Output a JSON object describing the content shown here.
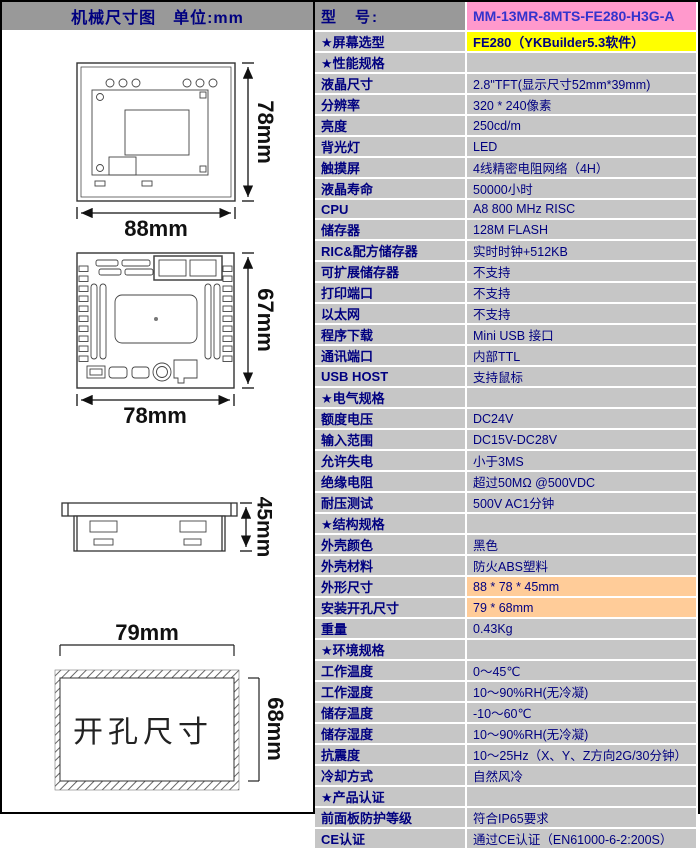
{
  "left_panel": {
    "header": "机械尺寸图　单位:mm",
    "front_view": {
      "width": "88mm",
      "height": "78mm"
    },
    "back_view": {
      "width": "78mm",
      "height": "67mm"
    },
    "side_view": {
      "depth": "45mm"
    },
    "cutout": {
      "width": "79mm",
      "height": "68mm",
      "label": "开孔尺寸"
    }
  },
  "spec_table": {
    "rows": [
      {
        "type": "model",
        "label": "型　号:",
        "value": "MM-13MR-8MTS-FE280-H3G-A"
      },
      {
        "type": "yellow",
        "label": "★屏幕选型",
        "value": "FE280（YKBuilder5.3软件）"
      },
      {
        "type": "section",
        "label": "★性能规格",
        "value": ""
      },
      {
        "type": "normal",
        "label": "液晶尺寸",
        "value": "2.8\"TFT(显示尺寸52mm*39mm)"
      },
      {
        "type": "normal",
        "label": "分辨率",
        "value": "320 * 240像素"
      },
      {
        "type": "normal",
        "label": "亮度",
        "value": "250cd/m"
      },
      {
        "type": "normal",
        "label": "背光灯",
        "value": "LED"
      },
      {
        "type": "normal",
        "label": "触摸屏",
        "value": "4线精密电阻网络（4H）"
      },
      {
        "type": "normal",
        "label": "液晶寿命",
        "value": "50000小时"
      },
      {
        "type": "normal",
        "label": "CPU",
        "value": "A8 800 MHz RISC"
      },
      {
        "type": "normal",
        "label": "储存器",
        "value": "128M FLASH"
      },
      {
        "type": "normal",
        "label": "RIC&配方储存器",
        "value": "实时时钟+512KB"
      },
      {
        "type": "normal",
        "label": "可扩展储存器",
        "value": "不支持"
      },
      {
        "type": "normal",
        "label": "打印端口",
        "value": "不支持"
      },
      {
        "type": "normal",
        "label": "以太网",
        "value": "不支持"
      },
      {
        "type": "normal",
        "label": "程序下载",
        "value": "Mini USB 接口"
      },
      {
        "type": "normal",
        "label": "通讯端口",
        "value": "内部TTL"
      },
      {
        "type": "normal",
        "label": "USB HOST",
        "value": "支持鼠标"
      },
      {
        "type": "section",
        "label": "★电气规格",
        "value": ""
      },
      {
        "type": "normal",
        "label": "额度电压",
        "value": "DC24V"
      },
      {
        "type": "normal",
        "label": "输入范围",
        "value": "DC15V-DC28V"
      },
      {
        "type": "normal",
        "label": "允许失电",
        "value": "小于3MS"
      },
      {
        "type": "normal",
        "label": "绝缘电阻",
        "value": "超过50MΩ @500VDC"
      },
      {
        "type": "normal",
        "label": "耐压测试",
        "value": "500V AC1分钟"
      },
      {
        "type": "section",
        "label": "★结构规格",
        "value": ""
      },
      {
        "type": "normal",
        "label": "外壳颜色",
        "value": "黑色"
      },
      {
        "type": "normal",
        "label": "外壳材料",
        "value": "防火ABS塑料"
      },
      {
        "type": "orange",
        "label": "外形尺寸",
        "value": "88 * 78 * 45mm"
      },
      {
        "type": "orange",
        "label": "安装开孔尺寸",
        "value": "79 * 68mm"
      },
      {
        "type": "normal",
        "label": "重量",
        "value": "0.43Kg"
      },
      {
        "type": "section",
        "label": "★环境规格",
        "value": ""
      },
      {
        "type": "normal",
        "label": "工作温度",
        "value": "0～45℃"
      },
      {
        "type": "normal",
        "label": "工作湿度",
        "value": "10～90%RH(无冷凝)"
      },
      {
        "type": "normal",
        "label": "储存温度",
        "value": "-10～60℃"
      },
      {
        "type": "normal",
        "label": "储存湿度",
        "value": "10～90%RH(无冷凝)"
      },
      {
        "type": "normal",
        "label": "抗震度",
        "value": "10～25Hz（X、Y、Z方向2G/30分钟）"
      },
      {
        "type": "normal",
        "label": "冷却方式",
        "value": "自然风冷"
      },
      {
        "type": "section",
        "label": "★产品认证",
        "value": ""
      },
      {
        "type": "normal",
        "label": "前面板防护等级",
        "value": "符合IP65要求"
      },
      {
        "type": "normal",
        "label": "CE认证",
        "value": "通过CE认证（EN61000-6-2:200S）"
      }
    ]
  },
  "colors": {
    "header-gray": "#999999",
    "row-silver": "#C6C6C6",
    "model-pink": "#FF99CC",
    "model-text-blue": "#3333CC",
    "highlight-yellow": "#FFFF00",
    "highlight-orange": "#FFCC99",
    "text-navy": "#000080",
    "border-white": "#FFFFFF"
  }
}
